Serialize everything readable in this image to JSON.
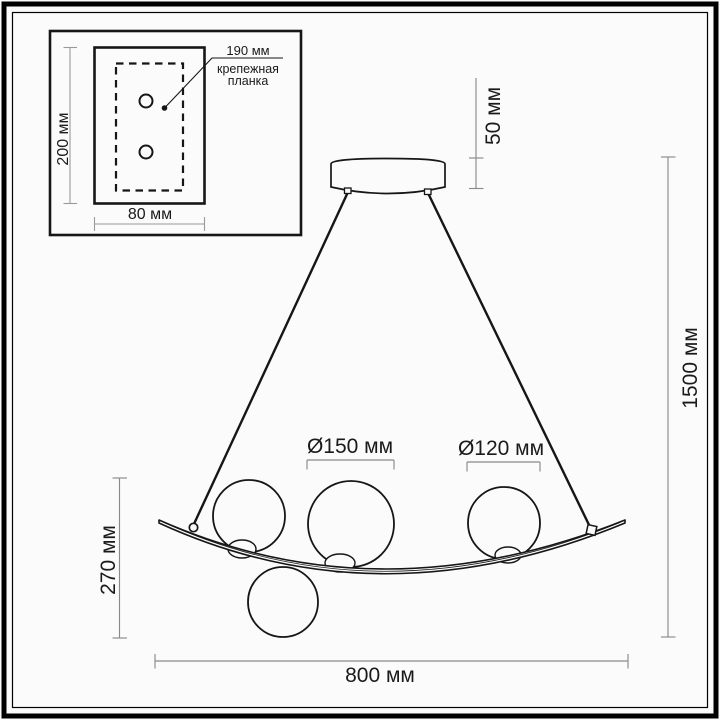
{
  "diagram": {
    "type": "pendant-lamp-dimension-drawing",
    "inset": {
      "plate_height": "200 мм",
      "plate_width": "80 мм",
      "bracket_length": "190 мм",
      "bracket_caption_line1": "крепежная",
      "bracket_caption_line2": "планка"
    },
    "dimensions": {
      "canopy_height": "50 мм",
      "suspension_total_height": "1500 мм",
      "fixture_height": "270 мм",
      "fixture_width": "800 мм",
      "globe_large_diameter": "Ø150 мм",
      "globe_small_diameter": "Ø120 мм"
    },
    "colors": {
      "background": "#fbfbfb",
      "drawing_line": "#161616",
      "dimension_line": "#8a8a8a",
      "text": "#1a1a1a",
      "frame": "#000000"
    }
  }
}
